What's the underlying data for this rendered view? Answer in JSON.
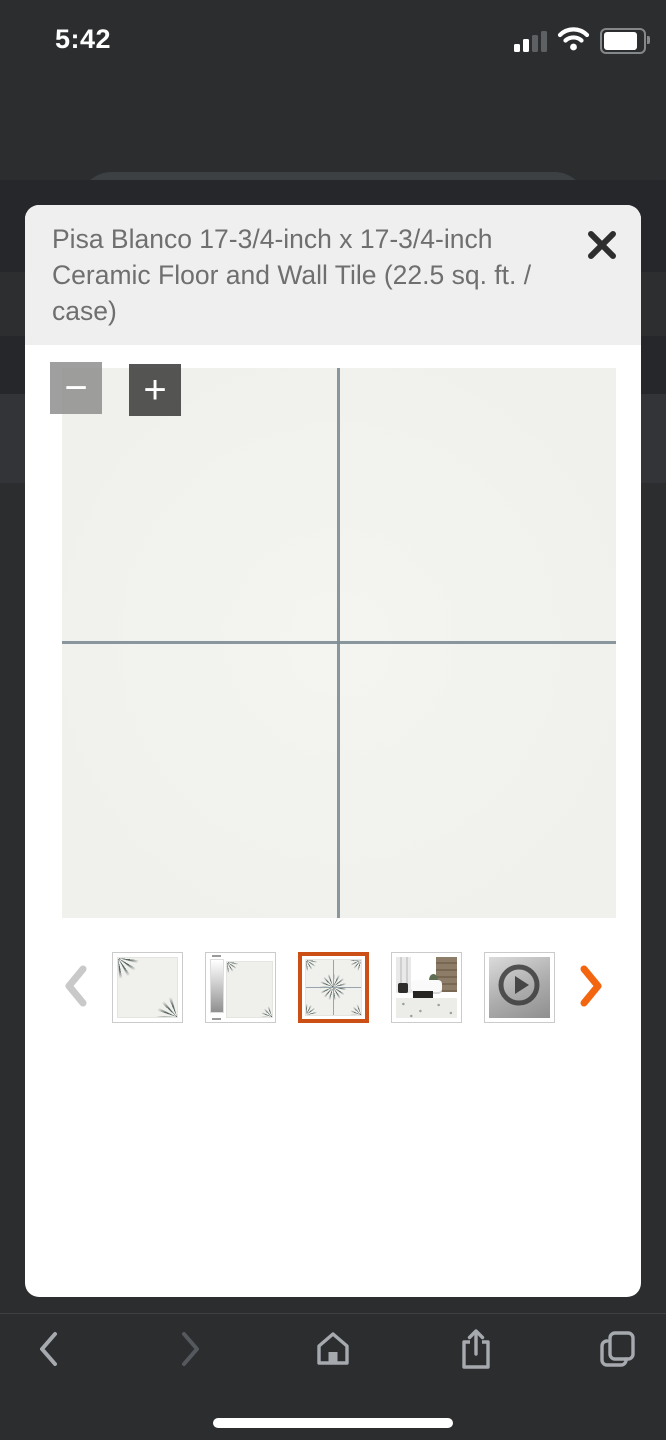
{
  "colors": {
    "accent_orange": "#F3650F",
    "selected_border_orange": "#CC5015",
    "pill_gray": "#3C4043",
    "grout": "#7D8C95",
    "tile_ray": "#485653"
  },
  "status_bar": {
    "time": "5:42",
    "icons": [
      "cellular-signal",
      "wifi",
      "battery"
    ]
  },
  "browser_bar": {
    "url": "www.homedepot.ca",
    "icons": [
      "back-chevron",
      "lock",
      "refresh",
      "bookmark",
      "voice-reader"
    ]
  },
  "modal": {
    "title": "Pisa Blanco 17-3/4-inch x 17-3/4-inch Ceramic Floor and Wall Tile (22.5 sq. ft. / case)",
    "close_icon": "x",
    "zoom_out_label": "−",
    "zoom_in_label": "+"
  },
  "carousel": {
    "selected_index": 2,
    "thumbnails": [
      {
        "kind": "tile-corner-fans"
      },
      {
        "kind": "tile-with-shade-scale"
      },
      {
        "kind": "four-tile-layout"
      },
      {
        "kind": "room-scene"
      },
      {
        "kind": "video"
      }
    ],
    "prev_enabled": false,
    "next_enabled": true
  },
  "bottom_nav": {
    "items": [
      "back",
      "forward",
      "home",
      "share",
      "tabs"
    ],
    "forward_enabled": false
  }
}
